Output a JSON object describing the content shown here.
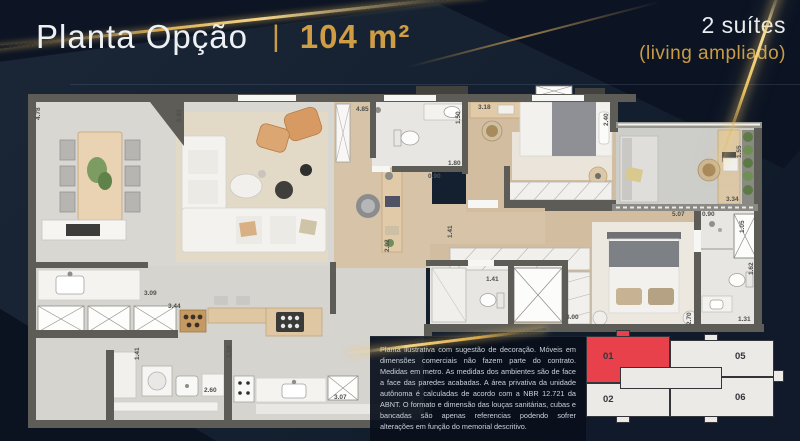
{
  "header": {
    "title": "Planta Opção",
    "separator": "|",
    "area": "104 m²",
    "suites": "2 suítes",
    "living": "(living ampliado)"
  },
  "plan": {
    "dims": [
      "4.78",
      "5.93",
      "4.85",
      "3.18",
      "1.50",
      "1.80",
      "0.90",
      "2.40",
      "1.55",
      "3.34",
      "5.07",
      "0.90",
      "1.05",
      "1.62",
      "1.31",
      "2.70",
      "3.00",
      "1.41",
      "1.41",
      "3.09",
      "3.44",
      "1.41",
      "1.68",
      "2.60",
      "3.07",
      "2.02"
    ]
  },
  "disclaimer": {
    "text": "Planta ilustrativa com sugestão de decoração. Móveis em dimensões comerciais não fazem parte do contrato. Medidas em metro. As medidas dos ambientes são de face a face das paredes acabadas. A área privativa da unidade autônoma é calculadas de acordo com a NBR 12.721 da ABNT. O formato e dimensão das louças sanitárias, cubas e bancadas são apenas referencias podendo sofrer alterações em função do memorial descritivo."
  },
  "keyplan": {
    "units": [
      {
        "label": "01",
        "highlighted": true
      },
      {
        "label": "05",
        "highlighted": false
      },
      {
        "label": "02",
        "highlighted": false
      },
      {
        "label": "06",
        "highlighted": false
      }
    ]
  },
  "colors": {
    "gold": "#CF9D44",
    "background": "#14202F",
    "unit_highlight": "#E8414B",
    "wall": "#5D5C57"
  }
}
